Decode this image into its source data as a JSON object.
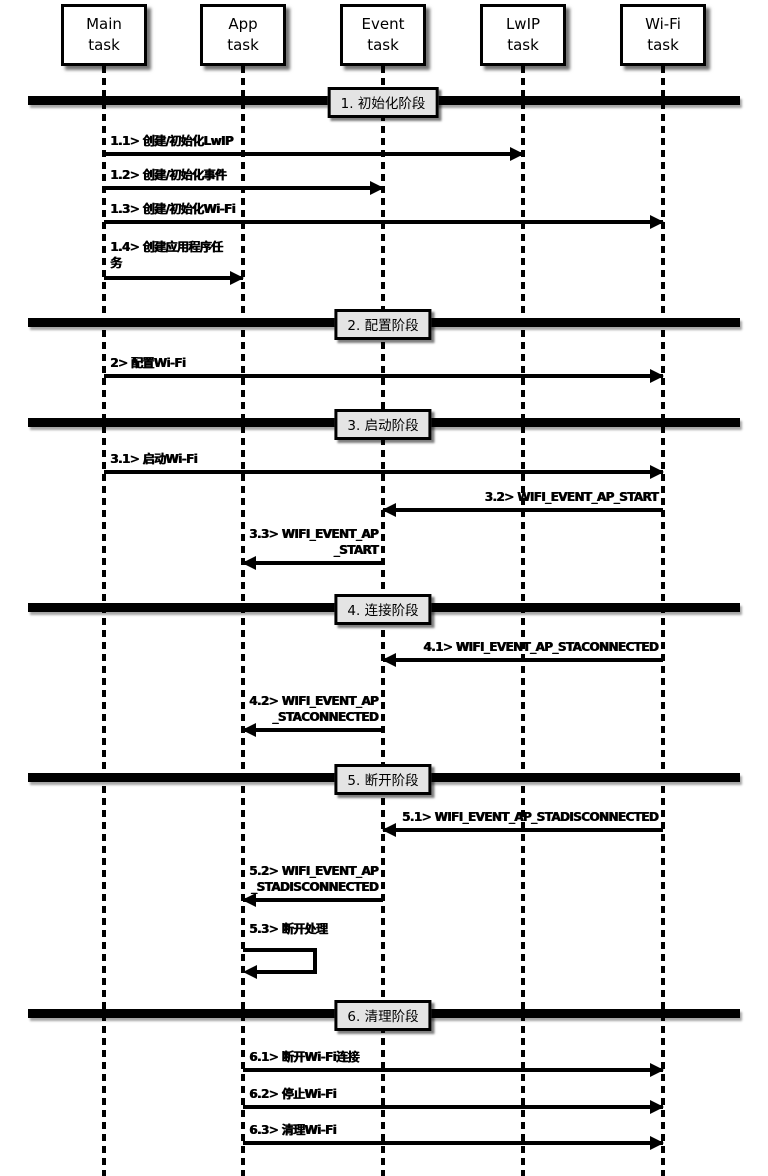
{
  "diagram_type": "sequence",
  "participants": [
    {
      "id": "main",
      "lines": [
        "Main",
        "task"
      ]
    },
    {
      "id": "app",
      "lines": [
        "App",
        "task"
      ]
    },
    {
      "id": "event",
      "lines": [
        "Event",
        "task"
      ]
    },
    {
      "id": "lwip",
      "lines": [
        "LwIP",
        "task"
      ]
    },
    {
      "id": "wifi",
      "lines": [
        "Wi-Fi",
        "task"
      ]
    }
  ],
  "phases": [
    {
      "label": "1. 初始化阶段",
      "messages": [
        {
          "id": "1.1",
          "from": "Main task",
          "to": "LwIP task",
          "lines": [
            "1.1> 创建/初始化LwIP"
          ]
        },
        {
          "id": "1.2",
          "from": "Main task",
          "to": "Event task",
          "lines": [
            "1.2> 创建/初始化事件"
          ]
        },
        {
          "id": "1.3",
          "from": "Main task",
          "to": "Wi-Fi task",
          "lines": [
            "1.3> 创建/初始化Wi-Fi"
          ]
        },
        {
          "id": "1.4",
          "from": "Main task",
          "to": "App task",
          "lines": [
            "1.4> 创建应用程序任",
            "务"
          ]
        }
      ]
    },
    {
      "label": "2. 配置阶段",
      "messages": [
        {
          "id": "2",
          "from": "Main task",
          "to": "Wi-Fi task",
          "lines": [
            "2> 配置Wi-Fi"
          ]
        }
      ]
    },
    {
      "label": "3. 启动阶段",
      "messages": [
        {
          "id": "3.1",
          "from": "Main task",
          "to": "Wi-Fi task",
          "lines": [
            "3.1> 启动Wi-Fi"
          ]
        },
        {
          "id": "3.2",
          "from": "Wi-Fi task",
          "to": "Event task",
          "lines": [
            "3.2> WIFI_EVENT_AP_START"
          ]
        },
        {
          "id": "3.3",
          "from": "Event task",
          "to": "App task",
          "lines": [
            "3.3> WIFI_EVENT_AP",
            "_START"
          ]
        }
      ]
    },
    {
      "label": "4. 连接阶段",
      "messages": [
        {
          "id": "4.1",
          "from": "Wi-Fi task",
          "to": "Event task",
          "lines": [
            "4.1> WIFI_EVENT_AP_STACONNECTED"
          ]
        },
        {
          "id": "4.2",
          "from": "Event task",
          "to": "App task",
          "lines": [
            "4.2> WIFI_EVENT_AP",
            "_STACONNECTED"
          ]
        }
      ]
    },
    {
      "label": "5. 断开阶段",
      "messages": [
        {
          "id": "5.1",
          "from": "Wi-Fi task",
          "to": "Event task",
          "lines": [
            "5.1> WIFI_EVENT_AP_STADISCONNECTED"
          ]
        },
        {
          "id": "5.2",
          "from": "Event task",
          "to": "App task",
          "lines": [
            "5.2> WIFI_EVENT_AP",
            "_STADISCONNECTED"
          ]
        },
        {
          "id": "5.3",
          "from": "App task",
          "to": "App task",
          "lines": [
            "5.3> 断开处理"
          ]
        }
      ]
    },
    {
      "label": "6. 清理阶段",
      "messages": [
        {
          "id": "6.1",
          "from": "App task",
          "to": "Wi-Fi task",
          "lines": [
            "6.1> 断开Wi-Fi连接"
          ]
        },
        {
          "id": "6.2",
          "from": "App task",
          "to": "Wi-Fi task",
          "lines": [
            "6.2> 停止Wi-Fi"
          ]
        },
        {
          "id": "6.3",
          "from": "App task",
          "to": "Wi-Fi task",
          "lines": [
            "6.3> 清理Wi-Fi"
          ]
        }
      ]
    }
  ],
  "colors": {
    "background": "#ffffff",
    "line": "#000000",
    "phase_box_bg": "#e4e4e4",
    "participant_box_bg": "#ffffff"
  }
}
